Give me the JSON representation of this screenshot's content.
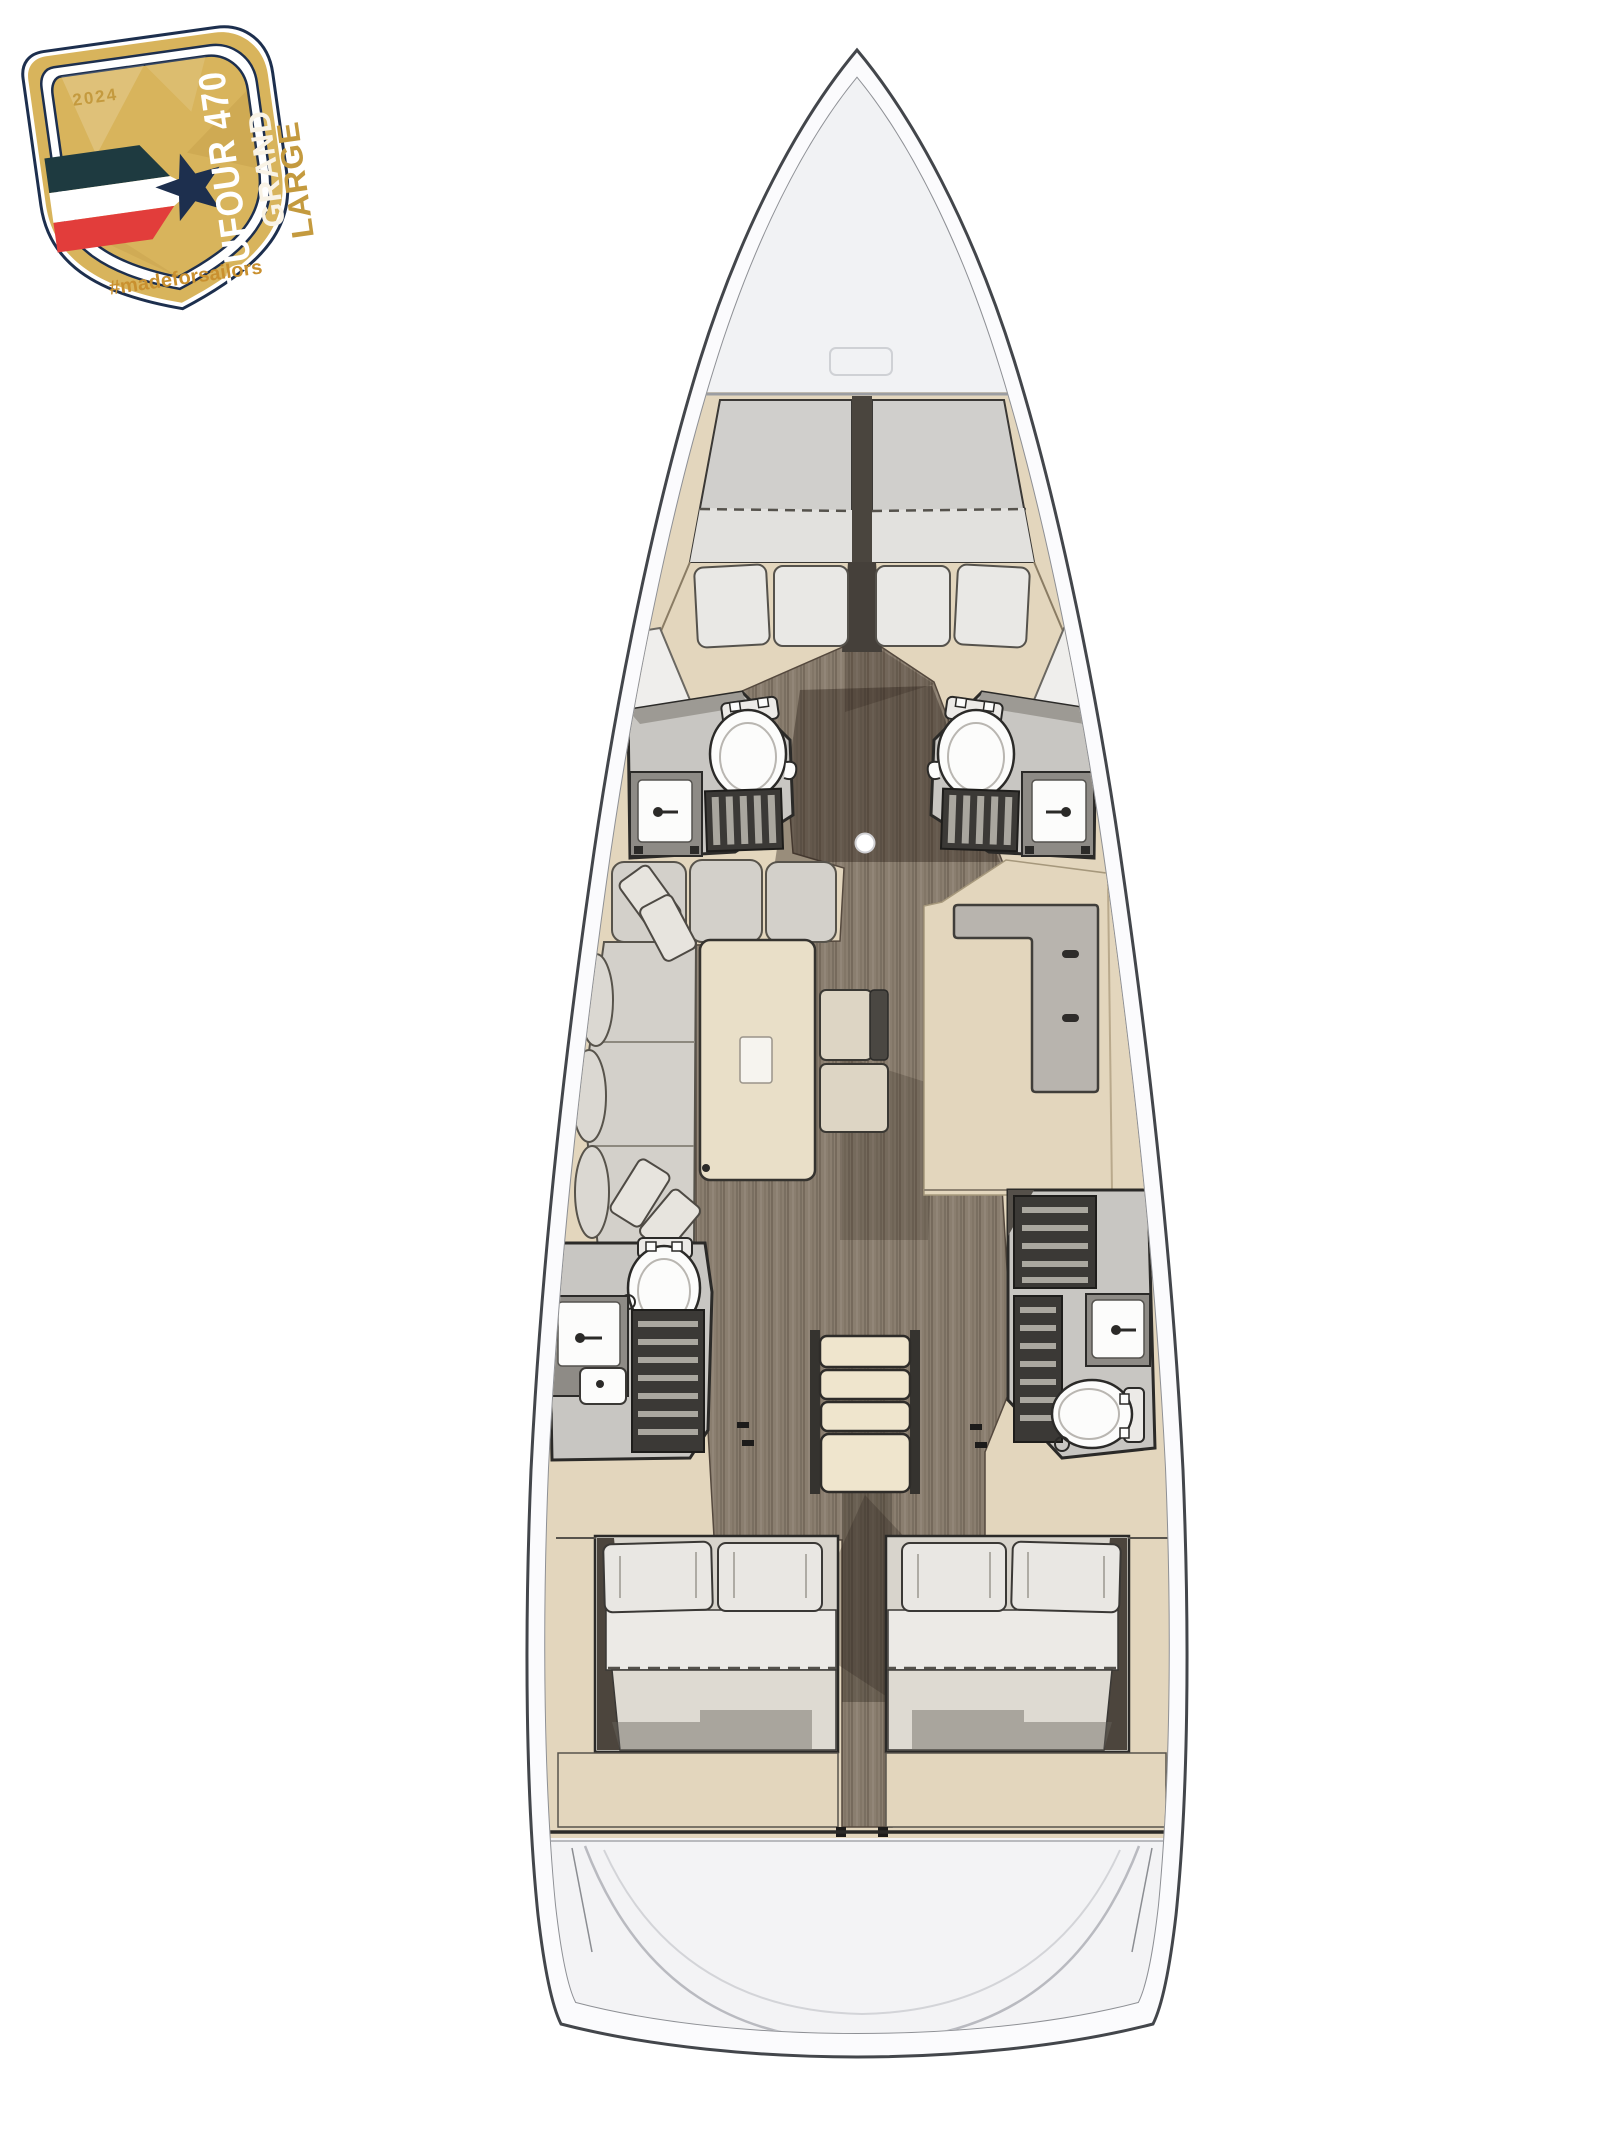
{
  "badge": {
    "year": "2024",
    "model": "DUFOUR 470",
    "series": [
      "GRAND",
      "LARGE"
    ],
    "hashtag": "#madeforsailors",
    "colors": {
      "gold": "#d8b45c",
      "gold_light": "#e8cf8a",
      "gold_deep": "#c49a3e",
      "navy": "#1d2f4e",
      "stripe_teal": "#1e3a40",
      "stripe_red": "#e23d3b",
      "cream": "#f9f3e6",
      "hashtag": "#c9902f"
    }
  },
  "palette": {
    "hull_outline": "#43464b",
    "hull_fill": "#fbfbfd",
    "deck_fill": "#f1f2f4",
    "joinery": "#e3d6bd",
    "joinery_dark": "#d2c3a4",
    "sole": "#8a7e6f",
    "sole_dark": "#584c41",
    "upholstery": "#d3d0ca",
    "mattress": "#eae8e4",
    "canvas": "#ddd8cf",
    "counter": "#b8b4ae",
    "wall": "#c8c6c2",
    "grate": "#3b3936",
    "fixture": "#fcfcfb",
    "ink": "#2b2a28"
  }
}
